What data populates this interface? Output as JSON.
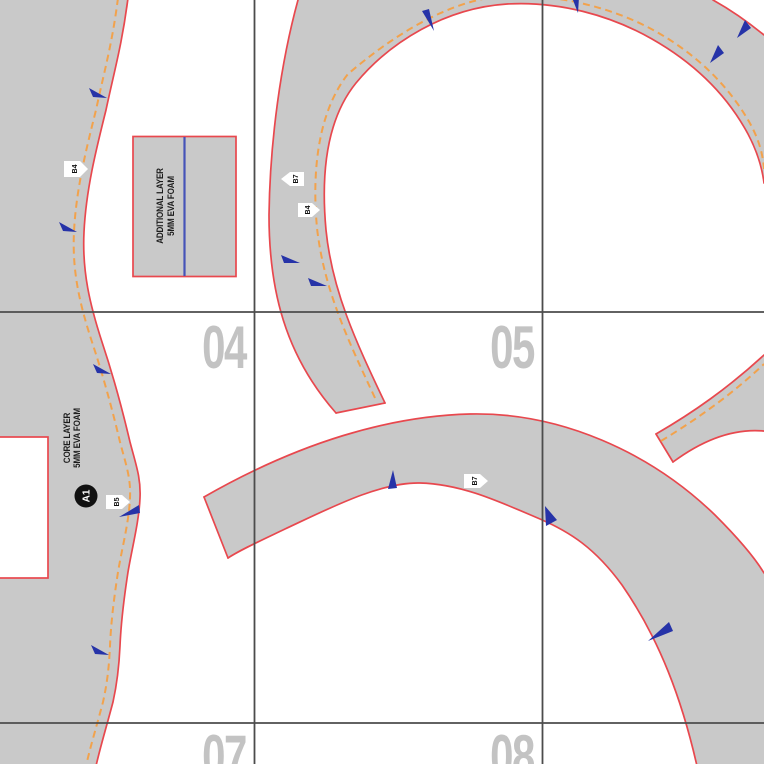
{
  "colors": {
    "piece_fill": "#c9c9c9",
    "cut_line": "#e8484e",
    "seam_allowance_dash": "#f2a24c",
    "notch": "#2633a8",
    "fold_line": "#4553b8",
    "grid_line": "#4c4c4c",
    "tile_number": "#c3c3c3"
  },
  "tiles": {
    "numbers": [
      {
        "label": "04"
      },
      {
        "label": "05"
      },
      {
        "label": "07"
      },
      {
        "label": "08"
      }
    ]
  },
  "labels": {
    "additional_layer": {
      "line1": "ADDITIONAL LAYER",
      "line2": "5MM EVA FOAM"
    },
    "core_layer": {
      "line1": "CORE LAYER",
      "line2": "5MM EVA FOAM"
    },
    "connector_badge": "A1",
    "tags": [
      {
        "label": "B4"
      },
      {
        "label": "B5"
      },
      {
        "label": "B7"
      },
      {
        "label": "B4"
      },
      {
        "label": "B7"
      }
    ]
  }
}
